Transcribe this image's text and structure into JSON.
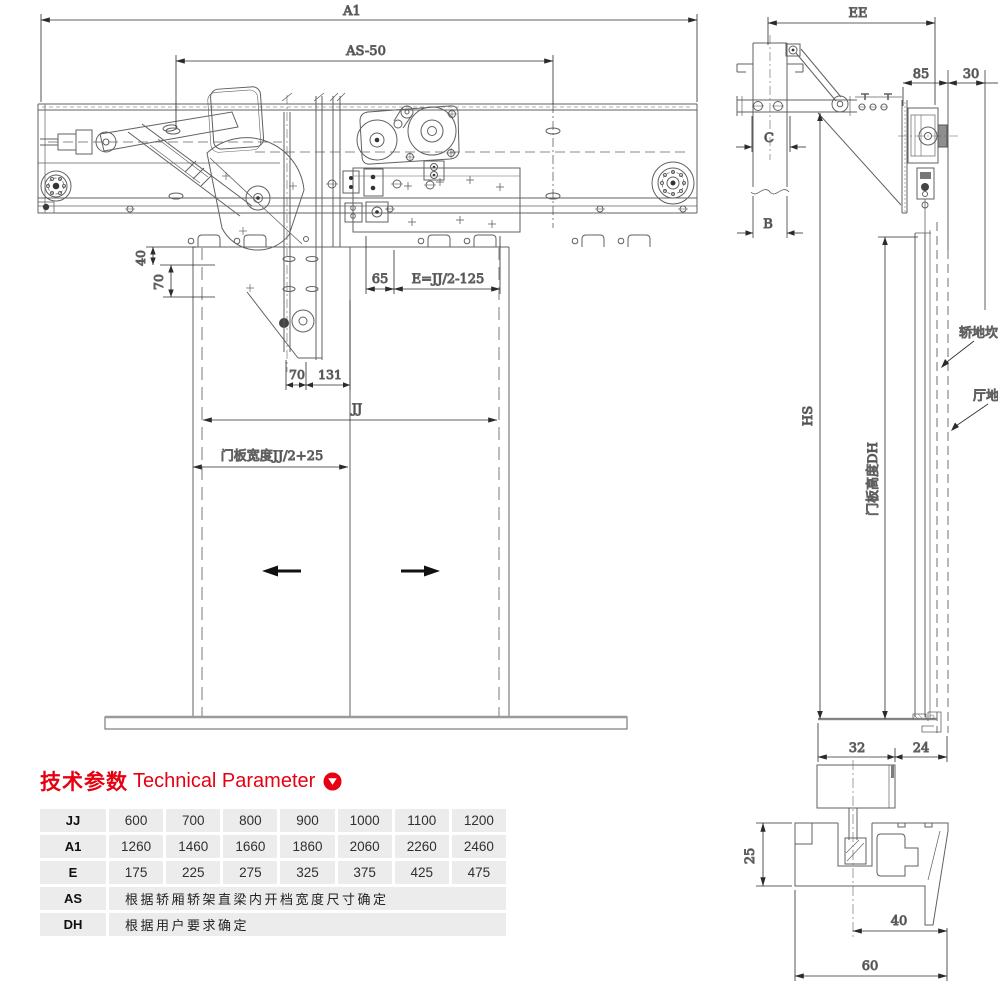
{
  "colors": {
    "accent": "#e60012",
    "line": "#5f5f5f",
    "dim": "#2b2b2b"
  },
  "front_view": {
    "dim_a1": "A1",
    "dim_as": "AS-50",
    "dim_40": "40",
    "dim_70_left": "70",
    "dim_65": "65",
    "dim_e": "E=JJ/2-125",
    "dim_70_mid": "70",
    "dim_131": "131",
    "dim_jj": "JJ",
    "door_width_label": "门板宽度JJ/2+25"
  },
  "side_view": {
    "dim_ee": "EE",
    "dim_85": "85",
    "dim_30": "30",
    "dim_c": "C",
    "dim_b": "B",
    "dim_hs": "HS",
    "door_height_label": "门板高度DH",
    "car_sill_label": "轿地坎",
    "hall_sill_label": "厅地坎"
  },
  "detail_view": {
    "dim_32": "32",
    "dim_24": "24",
    "dim_25": "25",
    "dim_40": "40",
    "dim_60": "60"
  },
  "parameter_table": {
    "title_zh": "技术参数",
    "title_en": "Technical Parameter",
    "rows": [
      {
        "label": "JJ",
        "values": [
          "600",
          "700",
          "800",
          "900",
          "1000",
          "1100",
          "1200"
        ]
      },
      {
        "label": "A1",
        "values": [
          "1260",
          "1460",
          "1660",
          "1860",
          "2060",
          "2260",
          "2460"
        ]
      },
      {
        "label": "E",
        "values": [
          "175",
          "225",
          "275",
          "325",
          "375",
          "425",
          "475"
        ]
      },
      {
        "label": "AS",
        "note": "根据轿厢轿架直梁内开档宽度尺寸确定"
      },
      {
        "label": "DH",
        "note": "根据用户要求确定"
      }
    ]
  }
}
